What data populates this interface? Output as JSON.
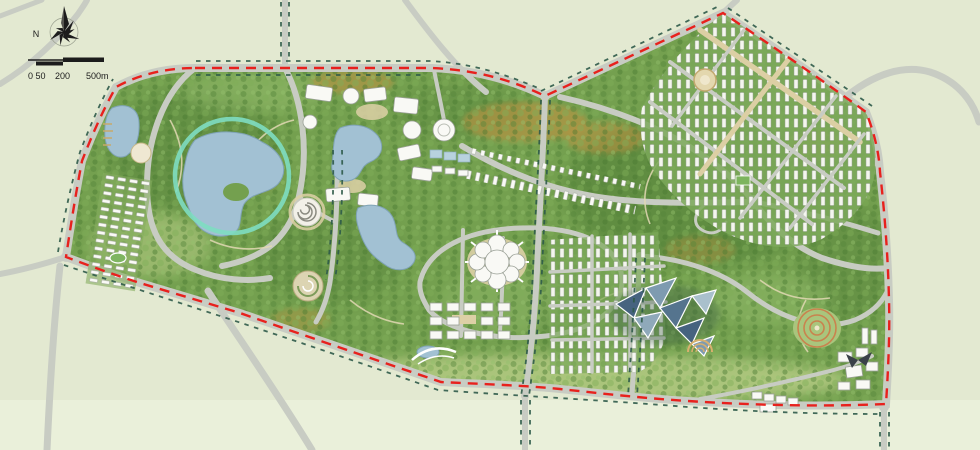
{
  "map": {
    "type": "landscape-master-plan",
    "legend": {
      "compass_label": "N"
    },
    "scale_bar": {
      "labels": [
        "0 50",
        "200",
        "500m"
      ]
    },
    "features": [
      "site-boundary",
      "central-lake",
      "lake-observation-ring",
      "northwest-pond",
      "west-residential-cluster",
      "northeast-residential-district",
      "central-campus-cluster",
      "flower-hall-building",
      "crystal-conservatories",
      "spiral-garden",
      "swirl-garden",
      "terraced-circle-garden",
      "amphitheater",
      "south-village-grid",
      "linear-strip-buildings",
      "southeast-building-cluster",
      "ring-roads",
      "north-compass",
      "scale-bar"
    ]
  },
  "colors": {
    "background": "#e3e9d1",
    "background_south": "#eaf0da",
    "road": "#c8ccc3",
    "park_green": "#74a04f",
    "park_dark": "#54813a",
    "park_light": "#96bd6e",
    "meadow": "#bdd08a",
    "autumn": "#c8903f",
    "water": "#a2c1d3",
    "water_edge": "#7fa3b5",
    "ring": "#7eddc1",
    "boundary": "#e8211d",
    "treeline": "#2d5a49",
    "building": "#f9f9f5",
    "building_edge": "#9aa096",
    "plaza": "#ddd0a6",
    "crystal": "#46637f",
    "ink": "#1c1c1c"
  }
}
